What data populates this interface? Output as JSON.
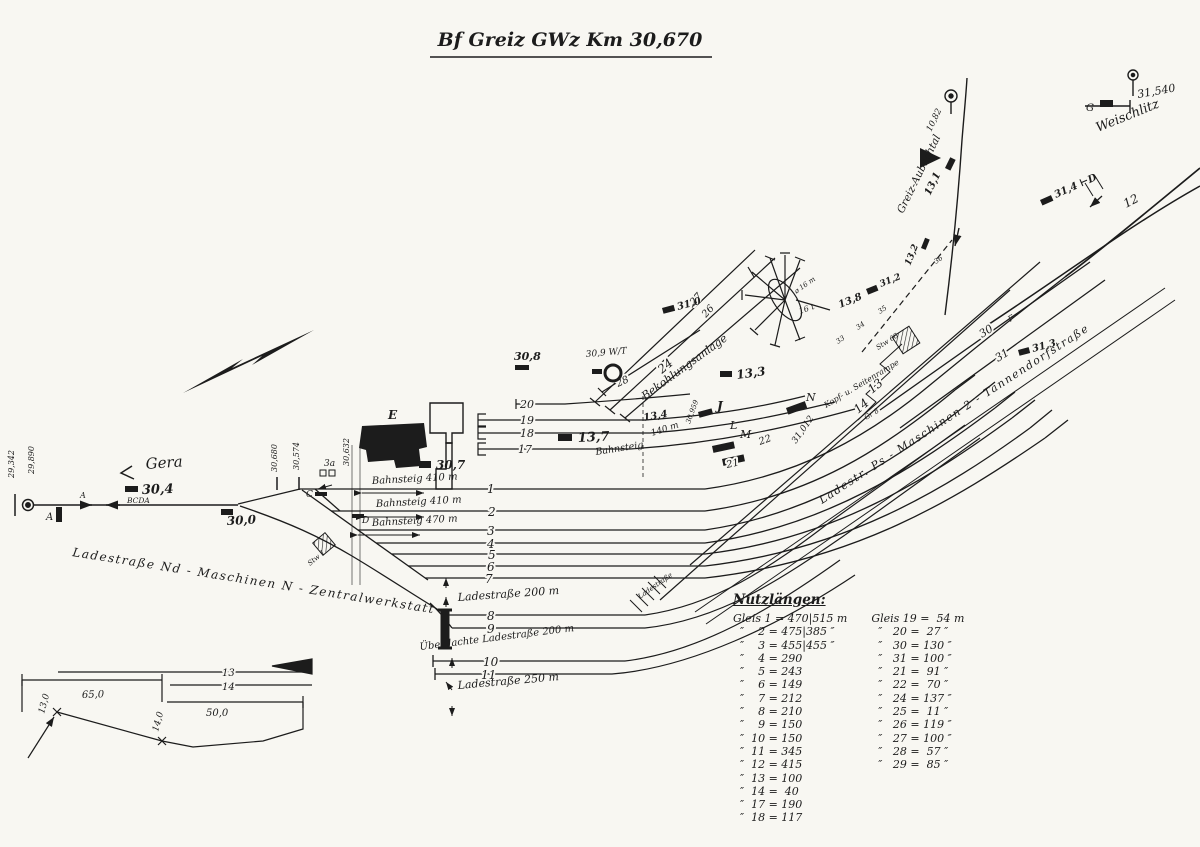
{
  "title": "Bf Greiz  GWz Km 30,670",
  "colors": {
    "paper": "#f8f7f2",
    "ink": "#1c1c1c"
  },
  "endpoints": {
    "gera": "Gera",
    "weischlitz": "Weischlitz",
    "branch": "Greiz-Aubachtal",
    "exit_track": "12"
  },
  "km": {
    "k29342": "29,342",
    "k29890": "29,890",
    "k30_4": "30,4",
    "bcda": "BCDA",
    "k30_0": "30,0",
    "k30680": "30,680",
    "k30574": "30,574",
    "k30632": "30,632",
    "k30_7": "30,7",
    "k30_8": "30,8",
    "k30_9": "30,9 W/T",
    "k13_7": "13,7",
    "k13_4": "13,4",
    "k13_3": "13,3",
    "k13_8": "13,8",
    "k13_1": "13,1",
    "k13_2": "13,2",
    "k31_0": "31,0",
    "k31_2": "31,2",
    "k31_3": "31,3",
    "k31_4": "31,4 ⊢D",
    "k31540": "31,540",
    "k31012": "31,012",
    "k30959": "30,959",
    "k10_82": "10,82"
  },
  "letters": {
    "a1": "A",
    "a2": "A",
    "c": "C",
    "d": "D",
    "e": "E",
    "g": "G",
    "j": "J",
    "l": "L",
    "m": "M",
    "n": "N",
    "x3a": "3a",
    "f": "F"
  },
  "tracks": {
    "n1": "1",
    "n2": "2",
    "n3": "3",
    "n4": "4",
    "n5": "5",
    "n6": "6",
    "n7": "7",
    "n8": "8",
    "n9": "9",
    "n10": "10",
    "n11": "11",
    "n17": "17",
    "n18": "18",
    "n19": "19",
    "n20": "20",
    "n13": "13",
    "n14": "14",
    "n21": "21",
    "n22": "22",
    "n24": "24",
    "n26": "26",
    "n27": "27",
    "n28": "28",
    "n30": "30",
    "n31": "31",
    "s33": "33",
    "s34": "34",
    "s35": "35",
    "s36": "36"
  },
  "texts": {
    "bahnsteig_410a": "Bahnsteig 410 m",
    "bahnsteig_410b": "Bahnsteig 410 m",
    "bahnsteig_470": "Bahnsteig 470 m",
    "bahnsteig_mid": "Bahnsteig",
    "bahnsteig_mid_len": "140 m",
    "lade200a": "Ladestraße 200 m",
    "lade200b": "Überdachte Ladestraße 200 m",
    "lade250": "Ladestraße 250 m",
    "lade_small": "Ladestraße",
    "bekohlung": "Bekohlungsanlage",
    "ladestr_left": "Ladestraße Nd - Maschinen N - Zentralwerkstatt",
    "ladestr_right": "Ladestr. Ps - Maschinen 2 - Tannendorfstraße",
    "kopframpe": "Kopf- u. Seitenrampe",
    "gr8": "Gr 8",
    "stw1": "Stw 1",
    "stw68": "Stw 68",
    "tt_d": "⌀ 16 m",
    "tt_t": "16 t"
  },
  "inset": {
    "t13": "13",
    "t14": "14",
    "d65": "65,0",
    "d50": "50,0",
    "d13": "13,0",
    "d14": "14,0"
  },
  "nutz": {
    "title": "Nutzlängen:",
    "left": [
      "Gleis 1 = 470|515 m",
      "  ″    2 = 475|385 ″",
      "  ″    3 = 455|455 ″",
      "  ″    4 = 290",
      "  ″    5 = 243",
      "  ″    6 = 149",
      "  ″    7 = 212",
      "  ″    8 = 210",
      "  ″    9 = 150",
      "  ″  10 = 150",
      "  ″  11 = 345",
      "  ″  12 = 415",
      "  ″  13 = 100",
      "  ″  14 =  40",
      "  ″  17 = 190",
      "  ″  18 = 117"
    ],
    "right": [
      "Gleis 19 =  54 m",
      "  ″   20 =  27 ″",
      "  ″   30 = 130 ″",
      "  ″   31 = 100 ″",
      "  ″   21 =  91 ″",
      "  ″   22 =  70 ″",
      "  ″   24 = 137 ″",
      "  ″   25 =  11 ″",
      "  ″   26 = 119 ″",
      "  ″   27 = 100 ″",
      "  ″   28 =  57 ″",
      "  ″   29 =  85 ″"
    ]
  }
}
